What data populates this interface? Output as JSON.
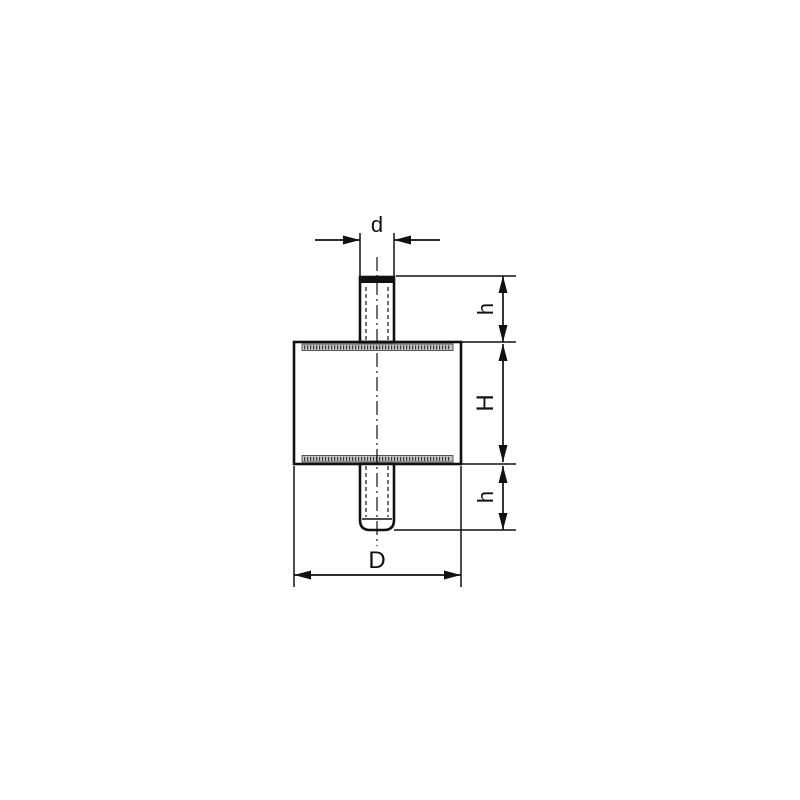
{
  "drawing": {
    "labels": {
      "d": "d",
      "h_top": "h",
      "H": "H",
      "h_bottom": "h",
      "D": "D"
    },
    "colors": {
      "rubber_body": "#ec1c24",
      "metal_plate": "#c6c6c6",
      "lines": "#111111",
      "background": "#ffffff"
    }
  }
}
